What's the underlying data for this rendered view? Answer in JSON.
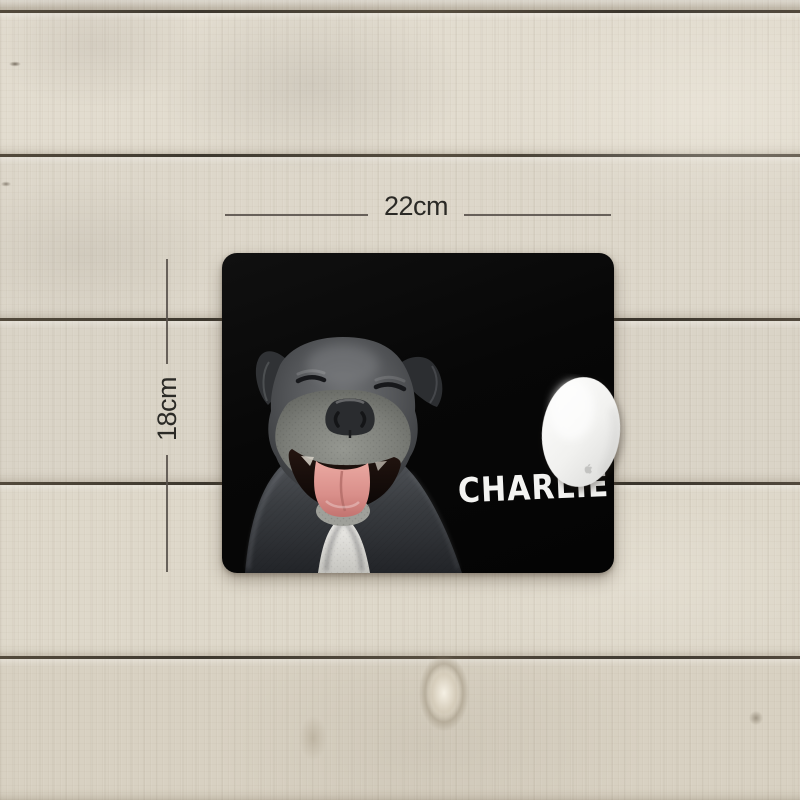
{
  "annotations": {
    "width_label": "22cm",
    "height_label": "18cm"
  },
  "mousepad": {
    "custom_name": "CHARLIE",
    "photo_alt": "smiling gray pit bull dog with closed eyes and pink tongue on black background",
    "surface_color": "#070707",
    "name_text_color": "#f3f3f1"
  },
  "scene": {
    "background_alt": "whitewashed wood plank desk",
    "mouse_alt": "white wireless computer mouse",
    "colors": {
      "wood_light": "#e2dccf",
      "wood_seam": "#332d23",
      "dimension_line": "#57504a",
      "dimension_text": "#2b2a26",
      "tongue_pink": "#d98f8a",
      "dog_gray": "#55575a"
    }
  }
}
